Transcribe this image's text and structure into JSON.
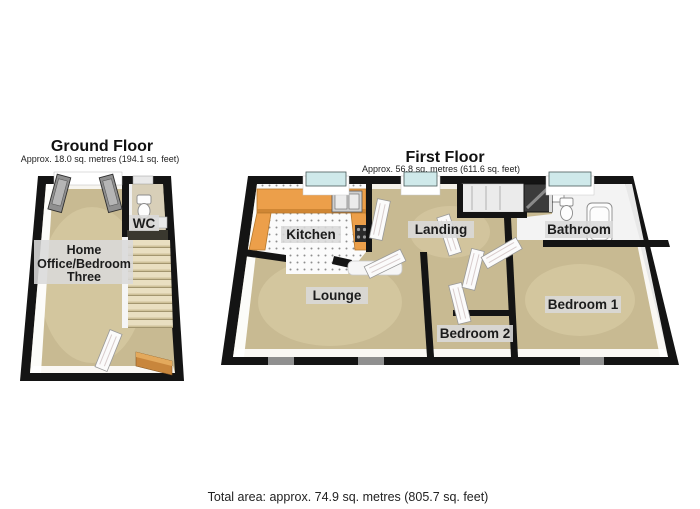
{
  "ground_floor": {
    "title": "Ground Floor",
    "subtitle": "Approx. 18.0 sq. metres (194.1 sq. feet)",
    "labels": {
      "wc": "WC",
      "home_office_line1": "Home",
      "home_office_line2": "Office/Bedroom",
      "home_office_line3": "Three"
    }
  },
  "first_floor": {
    "title": "First Floor",
    "subtitle": "Approx. 56.8 sq. metres (611.6 sq. feet)",
    "labels": {
      "kitchen": "Kitchen",
      "landing": "Landing",
      "bathroom": "Bathroom",
      "lounge": "Lounge",
      "bedroom_2": "Bedroom 2",
      "bedroom_1": "Bedroom 1"
    }
  },
  "footer": {
    "total_area": "Total area: approx. 74.9 sq. metres (805.7 sq. feet)"
  },
  "colors": {
    "wall": "#141414",
    "floor": "#c8ba92",
    "floor_light": "#ddd1aa",
    "tile": "#fbfbfb",
    "counter": "#ec9f4a",
    "window": "#cfe9ea",
    "stairs": "#e9dfc1",
    "stairs_shadow": "#a3966f",
    "label_bg": "#d9d9d9",
    "door_gray": "#8f8f8f",
    "wood": "#c8863c",
    "dark_fixture": "#3b3b3b"
  }
}
